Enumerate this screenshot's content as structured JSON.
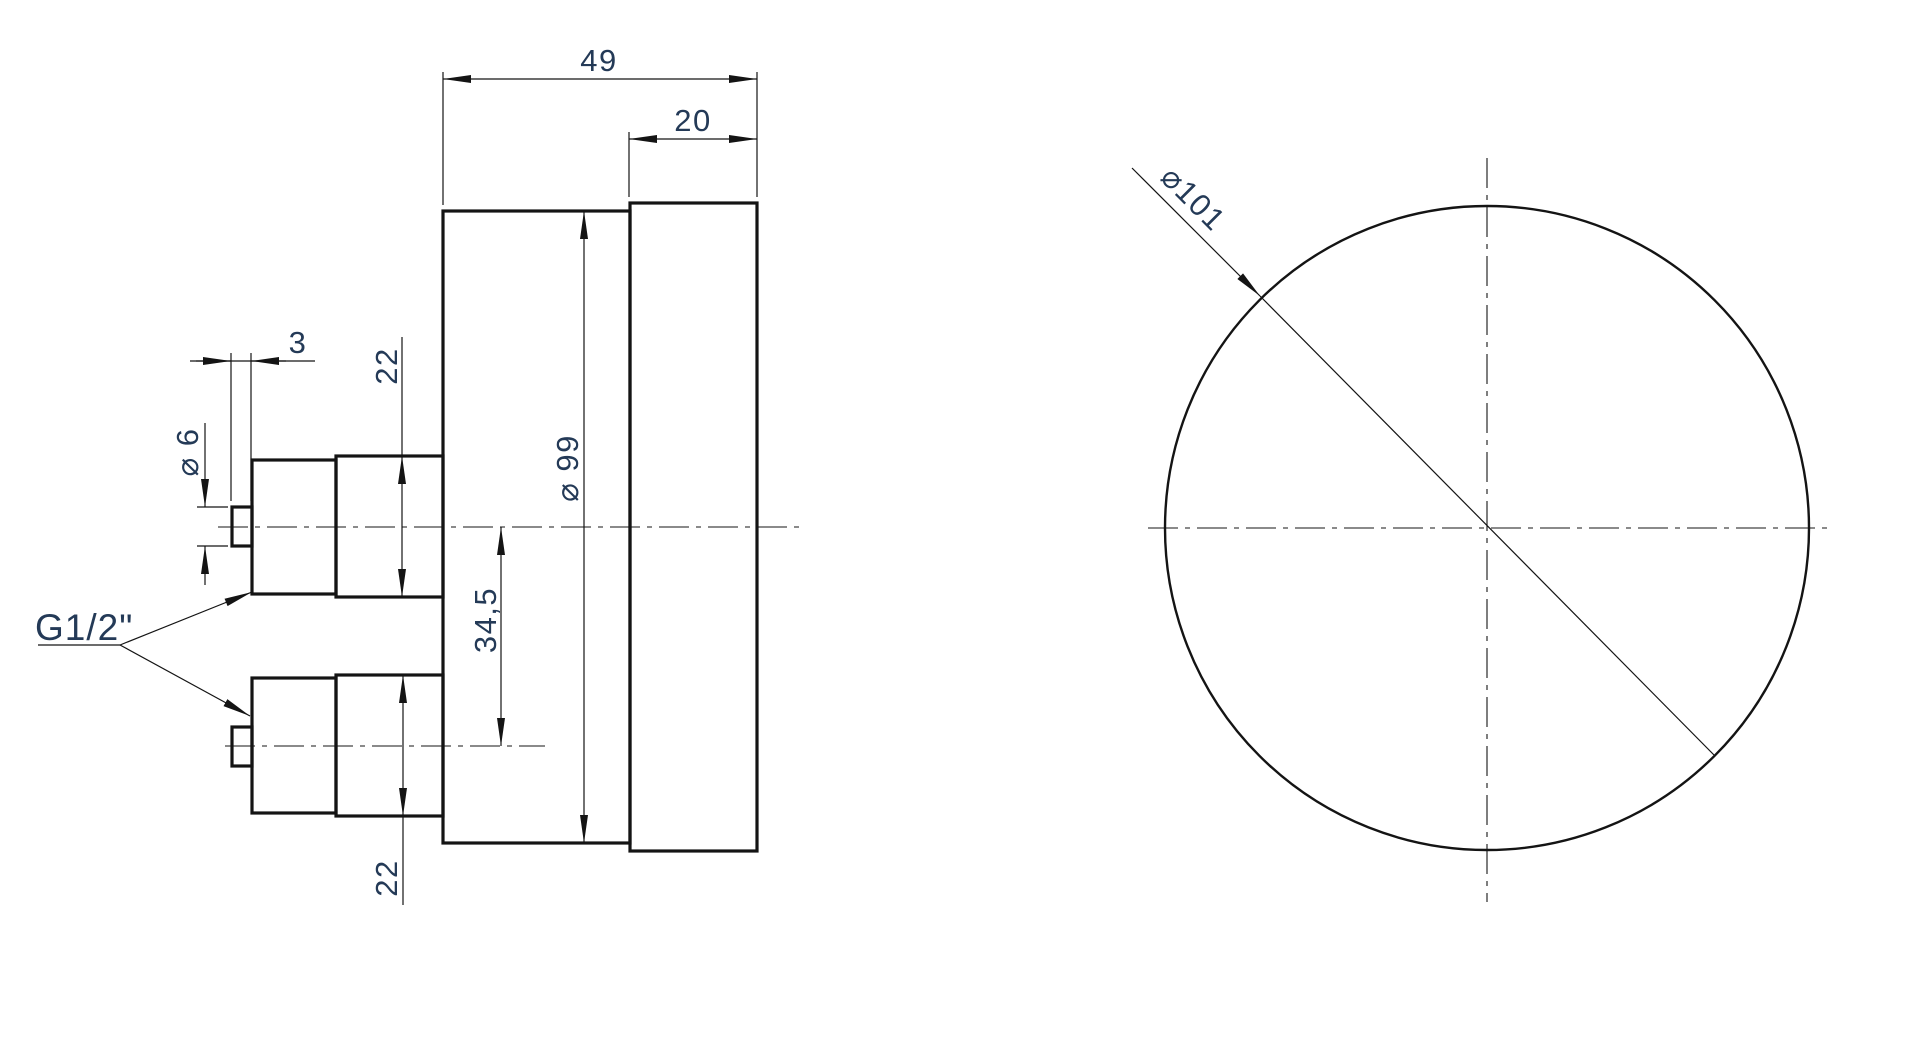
{
  "drawing": {
    "type": "engineering-drawing",
    "subject": "pressure gauge housing with two rear G1/2\" connections, side view and front view",
    "colors": {
      "background": "#ffffff",
      "line": "#141414",
      "dimension_text": "#243a57"
    },
    "side_view": {
      "dims": {
        "total_depth": "49",
        "bezel_depth": "20",
        "nipple_length": "3",
        "nipple_diameter": "⌀ 6",
        "boss_width_top": "22",
        "case_diameter": "⌀ 99",
        "axis_offset": "34,5",
        "boss_width_bottom": "22",
        "thread": "G1/2\""
      }
    },
    "front_view": {
      "dims": {
        "bezel_diameter": "⌀101"
      }
    }
  }
}
